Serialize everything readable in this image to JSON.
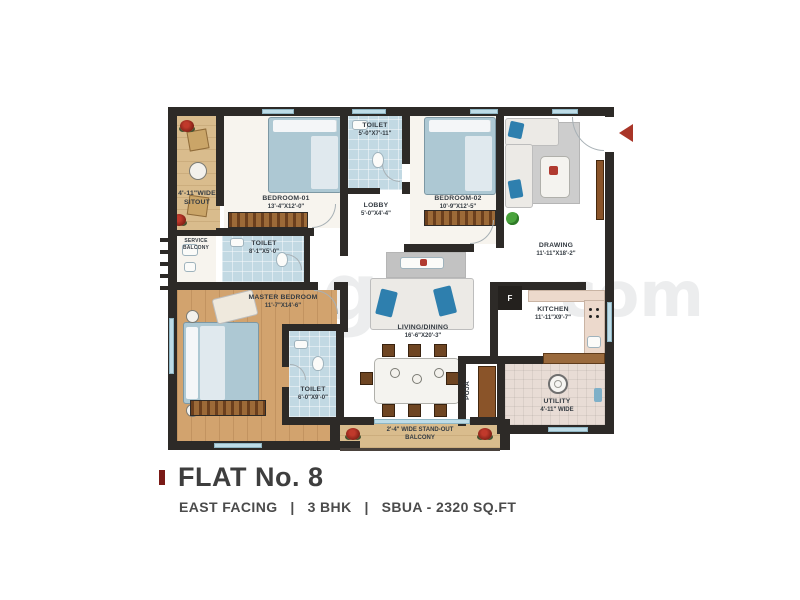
{
  "page": {
    "title": "FLAT No. 8",
    "subtitle": "EAST FACING   |   3 BHK   |   SBUA - 2320 SQ.FT"
  },
  "watermark": {
    "frag1": "g",
    "frag2": "com"
  },
  "rooms": {
    "sitout": {
      "line1": "4'-11\"WIDE",
      "line2": "SITOUT"
    },
    "service_balcony": {
      "line1": "SERVICE",
      "line2": "BALCONY"
    },
    "bedroom01": {
      "name": "BEDROOM-01",
      "dims": "13'-4\"X12'-0\""
    },
    "toilet_top": {
      "name": "TOILET",
      "dims": "5'-0\"X7'-11\""
    },
    "lobby": {
      "name": "LOBBY",
      "dims": "5'-0\"X4'-4\""
    },
    "bedroom02": {
      "name": "BEDROOM-02",
      "dims": "10'-9\"X12'-5\""
    },
    "drawing": {
      "name": "DRAWING",
      "dims": "11'-11\"X18'-2\""
    },
    "toilet_mid": {
      "name": "TOILET",
      "dims": "8'-1\"X5'-0\""
    },
    "master_bedroom": {
      "name": "MASTER BEDROOM",
      "dims": "11'-7\"X14'-6\""
    },
    "toilet_bottom": {
      "name": "TOILET",
      "dims": "6'-0\"X9'-0\""
    },
    "living_dining": {
      "name": "LIVING/DINING",
      "dims": "16'-6\"X20'-3\""
    },
    "kitchen": {
      "name": "KITCHEN",
      "dims": "11'-11\"X9'-7\""
    },
    "utility": {
      "name": "UTILITY",
      "dims": "4'-11\" WIDE"
    },
    "puja": {
      "name": "PUJA"
    },
    "balcony": {
      "line1": "2'-4\" WIDE STAND-OUT",
      "line2": "BALCONY"
    },
    "fridge": {
      "label": "F"
    }
  },
  "colors": {
    "wall": "#2d2a27",
    "wood_light": "#d9bc8d",
    "wood_dark": "#d2a36e",
    "tile_blue": "#c2d9e3",
    "counter": "#ecd9cc",
    "accent_red": "#a93528",
    "label_text": "#343b42",
    "title_text": "#3e3e3e"
  }
}
